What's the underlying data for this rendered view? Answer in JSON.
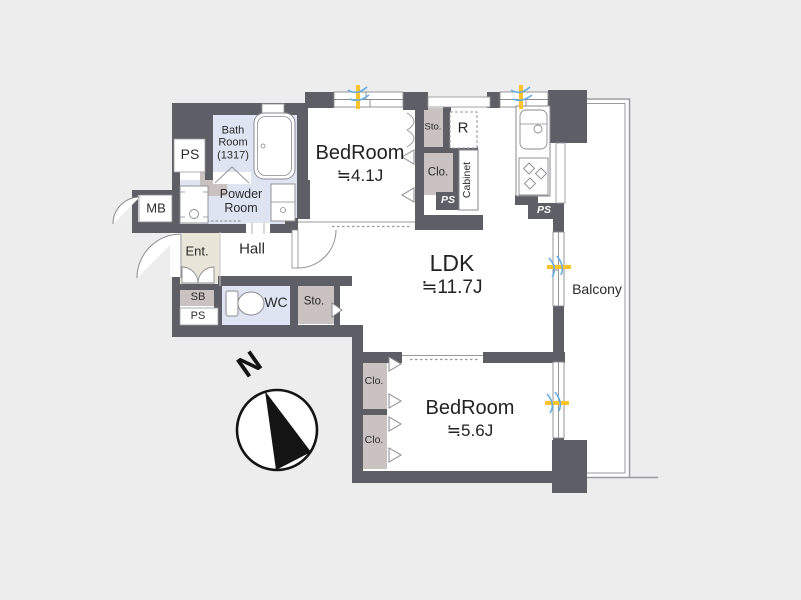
{
  "plan": {
    "type": "apartment-floor-plan",
    "compass": {
      "north_label": "N"
    },
    "rooms": {
      "ps_top_left": {
        "label": "PS"
      },
      "bath": {
        "label": "Bath Room (1317)"
      },
      "powder": {
        "label": "Powder Room"
      },
      "mb": {
        "label": "MB"
      },
      "entrance": {
        "label": "Ent."
      },
      "hall": {
        "label": "Hall"
      },
      "sb": {
        "label": "SB"
      },
      "ps_entrance": {
        "label": "PS"
      },
      "wc": {
        "label": "WC"
      },
      "storage_hall": {
        "label": "Sto."
      },
      "bedroom1": {
        "name": "BedRoom",
        "size": "≒4.1J"
      },
      "storage_top": {
        "label": "Sto."
      },
      "refrigerator": {
        "label": "R"
      },
      "closet_top": {
        "label": "Clo."
      },
      "ps_closet": {
        "label": "PS"
      },
      "cabinet": {
        "label": "Cabinet"
      },
      "ps_kitchen": {
        "label": "PS"
      },
      "ldk": {
        "name": "LDK",
        "size": "≒11.7J"
      },
      "balcony": {
        "label": "Balcony"
      },
      "closet_bottom_1": {
        "label": "Clo."
      },
      "closet_bottom_2": {
        "label": "Clo."
      },
      "bedroom2": {
        "name": "BedRoom",
        "size": "≒5.6J"
      }
    },
    "colors": {
      "background": "#ededed",
      "wall": "#5e5e66",
      "floor": "#ffffff",
      "wet_room": "#dfe4f2",
      "closet": "#c9c2c0",
      "entrance_floor": "#e9e5d8",
      "outline": "#8a8a90",
      "airflow_yellow": "#fcc42a",
      "airflow_blue": "#64aee3"
    }
  }
}
